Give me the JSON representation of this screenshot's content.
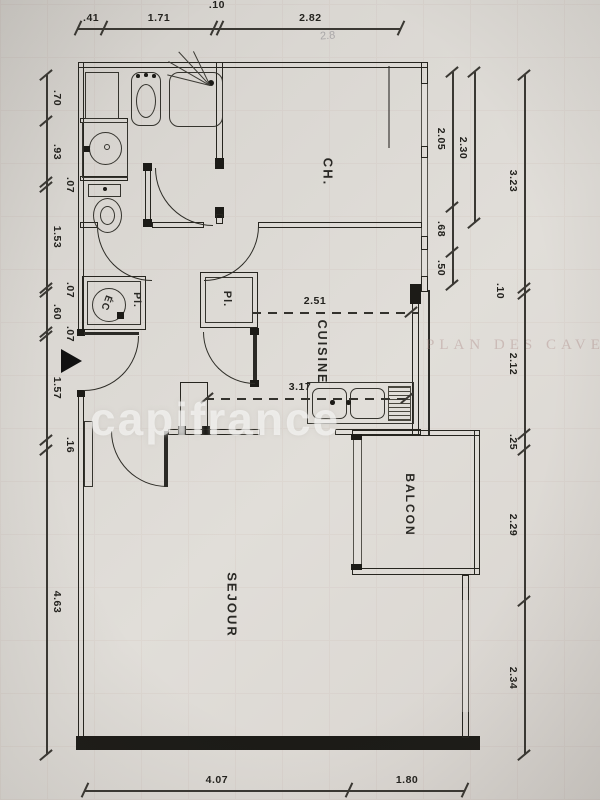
{
  "meta": {
    "watermark": "capifrance",
    "bleed_text": "PLAN DES CAVES",
    "pencil_note": "2.8"
  },
  "rooms": {
    "ch": {
      "label": "CH."
    },
    "cuisine": {
      "label": "CUISINE"
    },
    "sejour": {
      "label": "SEJOUR"
    },
    "balcon": {
      "label": "BALCON"
    },
    "placard_left": {
      "label": "Pl."
    },
    "placard_right": {
      "label": "Pl."
    },
    "water_heater": {
      "label": "ÉC"
    }
  },
  "dimensions": {
    "top": {
      "segments": [
        ".41",
        "1.71",
        ".10",
        "2.82"
      ]
    },
    "left": {
      "segments": [
        ".70",
        ".93",
        ".07",
        "1.53",
        ".07",
        ".60",
        ".07",
        "1.57",
        ".16",
        "4.63"
      ]
    },
    "right_outer": {
      "segments": [
        "3.23",
        ".10",
        "2.12",
        ".25",
        "2.29",
        "2.34"
      ]
    },
    "right_inner": {
      "segments": [
        "2.05",
        ".68",
        ".50"
      ]
    },
    "right_inner_b": {
      "segments": [
        "2.30"
      ]
    },
    "bottom": {
      "segments": [
        "4.07",
        "1.80"
      ]
    },
    "cuisine_internal": {
      "width": "2.51",
      "depth": "3.17"
    }
  }
}
